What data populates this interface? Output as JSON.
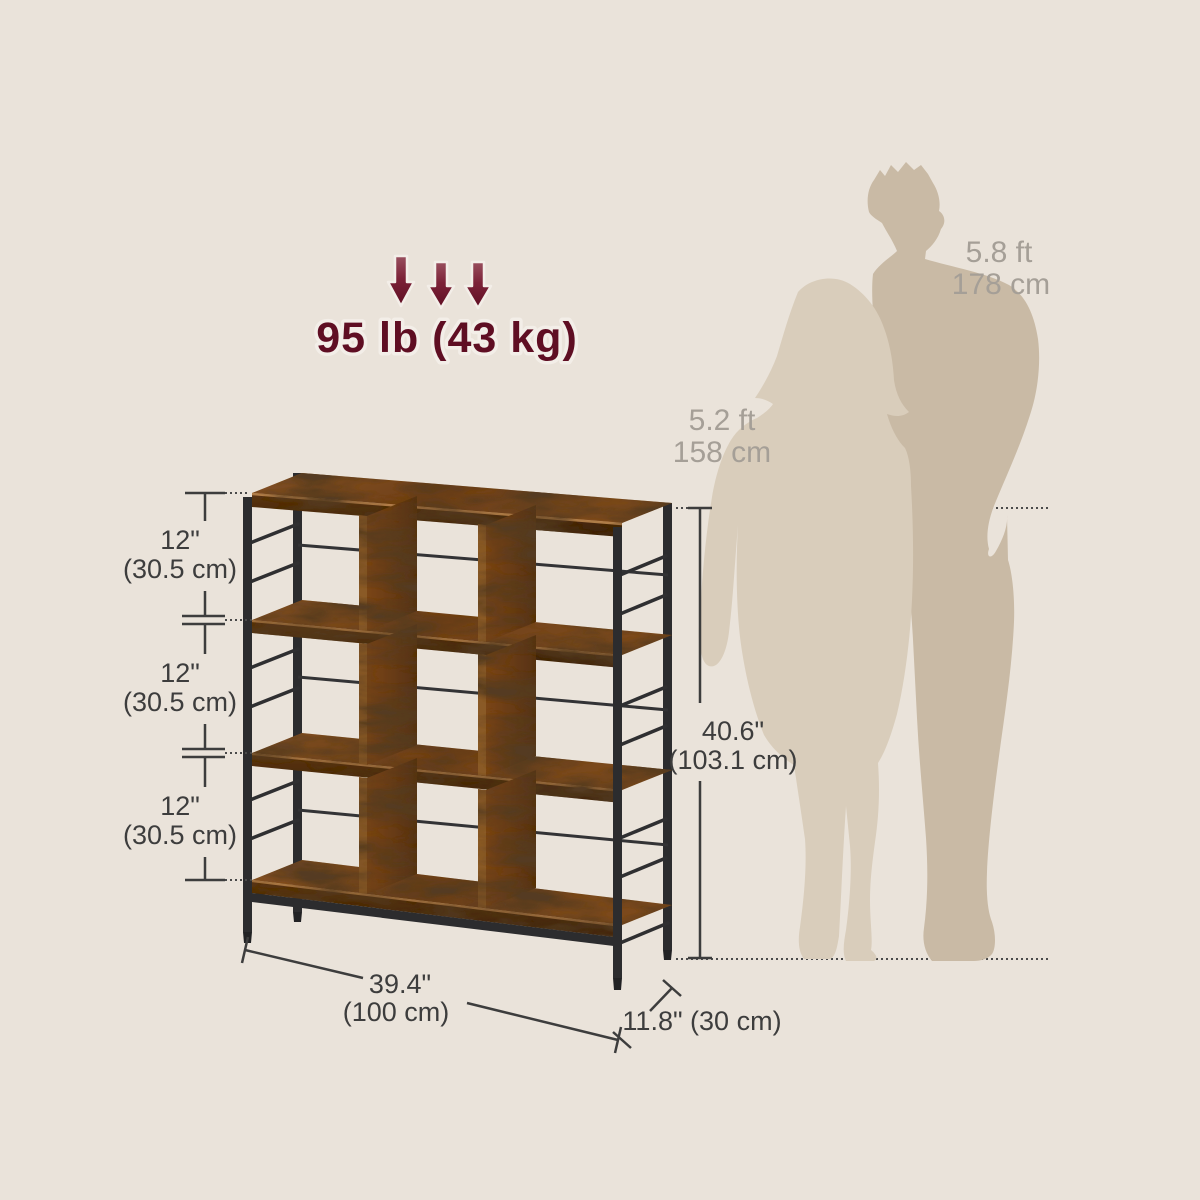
{
  "scene": {
    "background_color": "#EAE3DA",
    "type": "product-dimension-diagram"
  },
  "weight_capacity": {
    "label": "95 lb (43 kg)",
    "accent_color": "#5F0E23",
    "arrow_icon": "down-arrow-icon",
    "arrow_count": 3
  },
  "size_reference": {
    "male": {
      "height_ft": "5.8 ft",
      "height_cm": "178 cm"
    },
    "female": {
      "height_ft": "5.2 ft",
      "height_cm": "158 cm"
    },
    "text_color": "#A59F97",
    "male_silhouette_color": "#C9BAA5",
    "female_silhouette_color": "#D9CDBB"
  },
  "dimensions": {
    "text_color": "#3D3D3D",
    "side_tiers": [
      {
        "inches": "12\"",
        "cm": "(30.5 cm)"
      },
      {
        "inches": "12\"",
        "cm": "(30.5 cm)"
      },
      {
        "inches": "12\"",
        "cm": "(30.5 cm)"
      }
    ],
    "height": {
      "inches": "40.6\"",
      "cm": "(103.1 cm)"
    },
    "width": {
      "inches": "39.4\"",
      "cm": "(100 cm)"
    },
    "depth": {
      "label": "11.8\" (30 cm)"
    }
  },
  "product": {
    "wood_color": "#6B3D16",
    "metal_color": "#2C2C2E",
    "cubes": 9,
    "tiers": 3
  }
}
